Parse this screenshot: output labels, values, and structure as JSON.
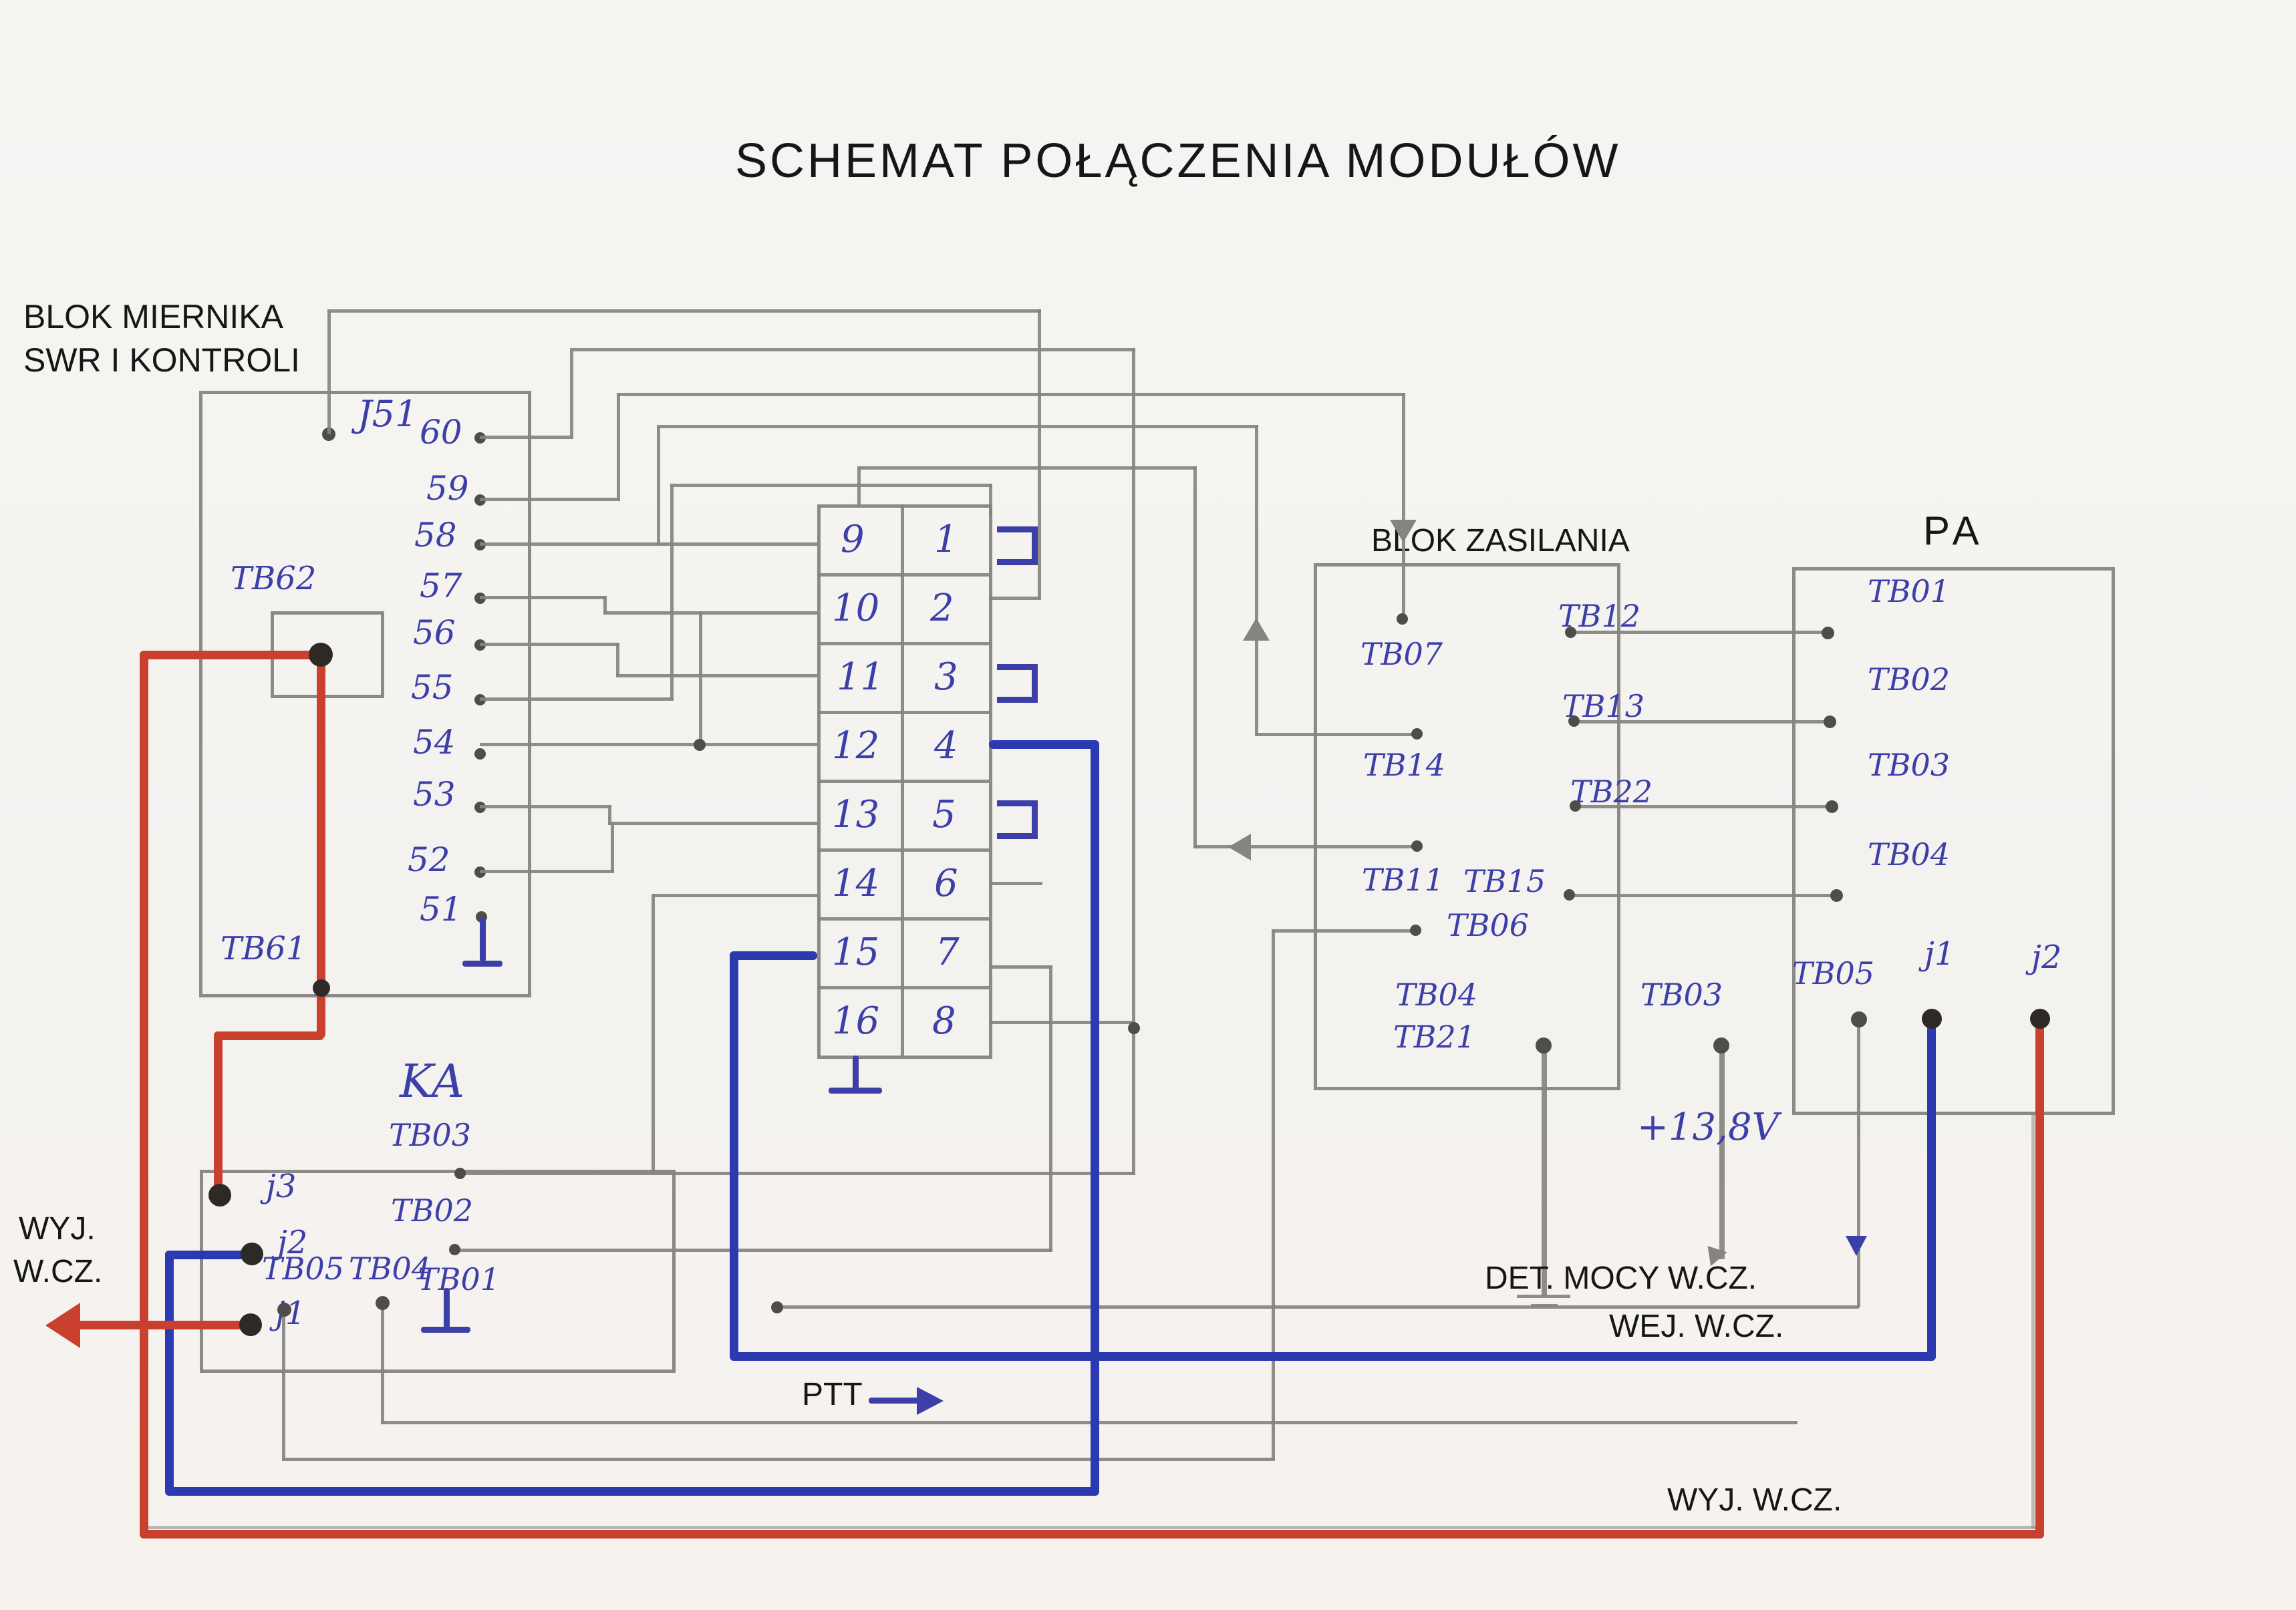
{
  "title": "SCHEMAT POŁĄCZENIA MODUŁÓW",
  "colors": {
    "paper": "#f6f4f1",
    "pencil": "#86847f",
    "ink_blue": "#3c3fa8",
    "marker_blue": "#2b3ab0",
    "marker_red": "#c9402f",
    "print_black": "#161616"
  },
  "left_block": {
    "label_line1": "BLOK MIERNIKA",
    "label_line2": "SWR I KONTROLI",
    "connector": "J51",
    "pins": [
      "60",
      "59",
      "58",
      "57",
      "56",
      "55",
      "54",
      "53",
      "52",
      "51"
    ],
    "tb62": "TB62",
    "tb61": "TB61"
  },
  "connector_table": {
    "left_pins": [
      "9",
      "10",
      "11",
      "12",
      "13",
      "14",
      "15",
      "16"
    ],
    "right_pins": [
      "1",
      "2",
      "3",
      "4",
      "5",
      "6",
      "7",
      "8"
    ]
  },
  "power_block": {
    "title": "BLOK ZASILANIA",
    "pin_tb07": "TB07",
    "pin_tb14": "TB14",
    "pin_tb11": "TB11",
    "pin_tb06": "TB06",
    "pin_tb04": "TB04",
    "pin_tb21": "TB21",
    "pin_tb03": "TB03",
    "pin_tb12": "TB12",
    "pin_tb13": "TB13",
    "pin_tb22": "TB22",
    "pin_tb15": "TB15",
    "voltage": "+13,8V"
  },
  "pa_block": {
    "title": "PA",
    "pin_tb01": "TB01",
    "pin_tb02": "TB02",
    "pin_tb03": "TB03",
    "pin_tb04": "TB04",
    "pin_tb05": "TB05",
    "pin_j1": "j1",
    "pin_j2": "j2"
  },
  "ka_block": {
    "title": "KA",
    "pin_j3": "j3",
    "pin_j2": "j2",
    "pin_j1": "j1",
    "pin_tb03": "TB03",
    "pin_tb02": "TB02",
    "pin_tb05": "TB05",
    "pin_tb04": "TB04",
    "pin_tb01": "TB01"
  },
  "signals": {
    "wyj_line1": "WYJ.",
    "wyj_line2": "W.CZ.",
    "det": "DET. MOCY W.CZ.",
    "wej": "WEJ. W.CZ.",
    "wyj_bottom": "WYJ. W.CZ.",
    "ptt": "PTT"
  }
}
